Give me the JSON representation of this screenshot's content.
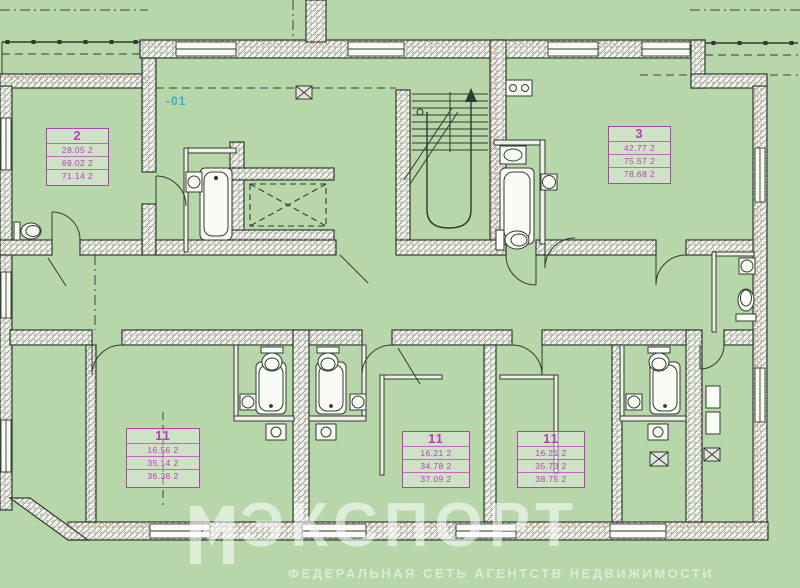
{
  "annotations": {
    "level_label": "-01"
  },
  "stamps": [
    {
      "num": "2",
      "rows": [
        "28.05 2",
        "69.02 2",
        "71.14 2"
      ]
    },
    {
      "num": "3",
      "rows": [
        "42.77 2",
        "75.57 2",
        "78.68 2"
      ]
    },
    {
      "num": "11",
      "rows": [
        "16.56 2",
        "35.14 2",
        "36.36 2"
      ]
    },
    {
      "num": "11",
      "rows": [
        "16.21 2",
        "34.78 2",
        "37.09 2"
      ]
    },
    {
      "num": "11",
      "rows": [
        "16.21 2",
        "35.73 2",
        "38.75 2"
      ]
    }
  ],
  "watermark": {
    "brand": "ЭКСПОРТ",
    "caption": "ФЕДЕРАЛЬНАЯ СЕТЬ АГЕНТСТВ НЕДВИЖИМОСТИ"
  },
  "colors": {
    "floor": "#b7d7aa",
    "wall_fill": "#f4f4ec",
    "hatch_line": "#98a096",
    "outline": "#2e3b2f",
    "brick_stipple": "#cf8f83",
    "stamp": "#bb3cbb",
    "annotation": "#35b0c4",
    "watermark": "#ffffff"
  },
  "plan": {
    "type": "apartment-floor-plan",
    "fixtures": [
      "bathtub",
      "toilet",
      "sink",
      "stairs",
      "elevator",
      "vent-shaft",
      "balcony-railing",
      "window",
      "door"
    ]
  }
}
